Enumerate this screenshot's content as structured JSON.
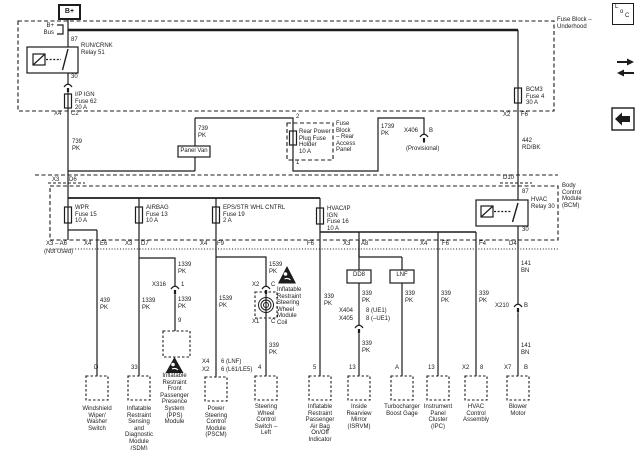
{
  "top": {
    "b_plus": "B+",
    "b_bus": "B+\nBus",
    "pin87": "87",
    "relay51": "RUN/CRNK\nRelay 51",
    "pin30": "30",
    "fuse62": "I/P IGN\nFuse 62\n20 A",
    "x4": "X4",
    "c2": "C2",
    "w739a": "739\nPK",
    "w739b": "739\nPK",
    "panel_van": "Panel Van",
    "pin2": "2",
    "pin1": "1",
    "rear_fuse": "Rear Power\nPlug Fuse\nHolder\n10 A",
    "rear_block": "Fuse\nBlock\n– Rear\nAccess\nPanel",
    "w1739": "1739\nPK",
    "x406": "X406",
    "x406_pin": "B",
    "provisional": "(Provisional)",
    "fuse_bcm3": "BCM3\nFuse 4\n30 A",
    "x2": "X2",
    "f6": "F6",
    "w442": "442\nRD/BK",
    "underhood": "Fuse Block –\nUnderhood"
  },
  "bcm": {
    "x3": "X3",
    "d6": "D6",
    "d10": "D10",
    "pin87": "87",
    "relay30": "HVAC\nRelay 30",
    "pin30": "30",
    "name": "Body\nControl\nModule\n(BCM)",
    "fuse_wpr": "WPR\nFuse 15\n10 A",
    "fuse_airbag": "AIRBAG\nFuse 13\n10 A",
    "fuse_eps": "EPS/STR WHL CNTRL\nFuse 19\n2 A",
    "fuse_hvac": "HVAC/IP\nIGN\nFuse 16\n10 A"
  },
  "row": {
    "a6": "X3 – A6",
    "not_used": "(Not Used)",
    "x4a": "X4",
    "e6": "E6",
    "x3a": "X3",
    "d7": "D7",
    "x4b": "X4",
    "f9": "F9",
    "f6a": "F6",
    "x3b": "X3",
    "a8": "A8",
    "x4c": "X4",
    "f6b": "F6",
    "f4": "F4",
    "d4": "D4"
  },
  "c1": {
    "wire": "439\nPK",
    "pin": "D",
    "name": "Windshield\nWiper/\nWasher\nSwitch"
  },
  "c2": {
    "wire": "1339\nPK",
    "pin": "33",
    "name": "Inflatable\nRestraint\nSensing\nand\nDiagnostic\nModule\n(SDM)"
  },
  "c3": {
    "w_upper": "1339\nPK",
    "x316": "X316",
    "x316_pin": "1",
    "w_lower": "1339\nPK",
    "pin": "9",
    "name": "Inflatable\nRestraint\nFront\nPassenger\nPresence\nSystem\n(PPS)\nModule"
  },
  "c4": {
    "wire": "1539\nPK",
    "pin_a": "X4",
    "pin_a2": "6 (LNF)",
    "pin_b": "X2",
    "pin_b2": "6 (L61/LE5)",
    "name": "Power\nSteering\nControl\nModule\n(PSCM)"
  },
  "c5": {
    "w_upper": "1539\nPK",
    "x2": "X2",
    "c_a": "C",
    "coil": "Inflatable\nRestraint\nSteering\nWheel\nModule\nCoil",
    "x1": "X1",
    "c_b": "C",
    "w_lower": "339\nPK",
    "pin": "4",
    "name": "Steering\nWheel\nControl\nSwitch –\nLeft"
  },
  "c6": {
    "wire": "339\nPK",
    "pin": "5",
    "name": "Inflatable\nRestraint\nPassenger\nAir Bag\nOn/Off\nIndicator"
  },
  "c7": {
    "dd8": "DD8",
    "w_upper": "339\nPK",
    "x404": "X404",
    "x405": "X405",
    "p404": "8 (UE1)",
    "p405": "8 (–UE1)",
    "w_lower": "339\nPK",
    "pin": "13",
    "name": "Inside\nRearview\nMirror\n(ISRVM)"
  },
  "c7b": {
    "lnf": "LNF",
    "wire": "339\nPK",
    "pin": "A",
    "name": "Turbocharger\nBoost Gage"
  },
  "c8": {
    "wire": "339\nPK",
    "pin": "13",
    "name": "Instrument\nPanel\nCluster\n(IPC)"
  },
  "c9": {
    "wire": "339\nPK",
    "pin_x": "X2",
    "pin_n": "8",
    "name": "HVAC\nControl\nAssembly"
  },
  "c10": {
    "w_upper": "141\nBN",
    "x210": "X210",
    "x210_pin": "B",
    "w_lower": "141\nBN",
    "pin_x": "X7",
    "pin_n": "B",
    "name": "Blower\nMotor"
  },
  "icons": {
    "loc_l": "L",
    "loc_o": "o",
    "loc_c": "C"
  },
  "colors": {
    "line": "#1c1c1c",
    "background": "#ffffff"
  }
}
